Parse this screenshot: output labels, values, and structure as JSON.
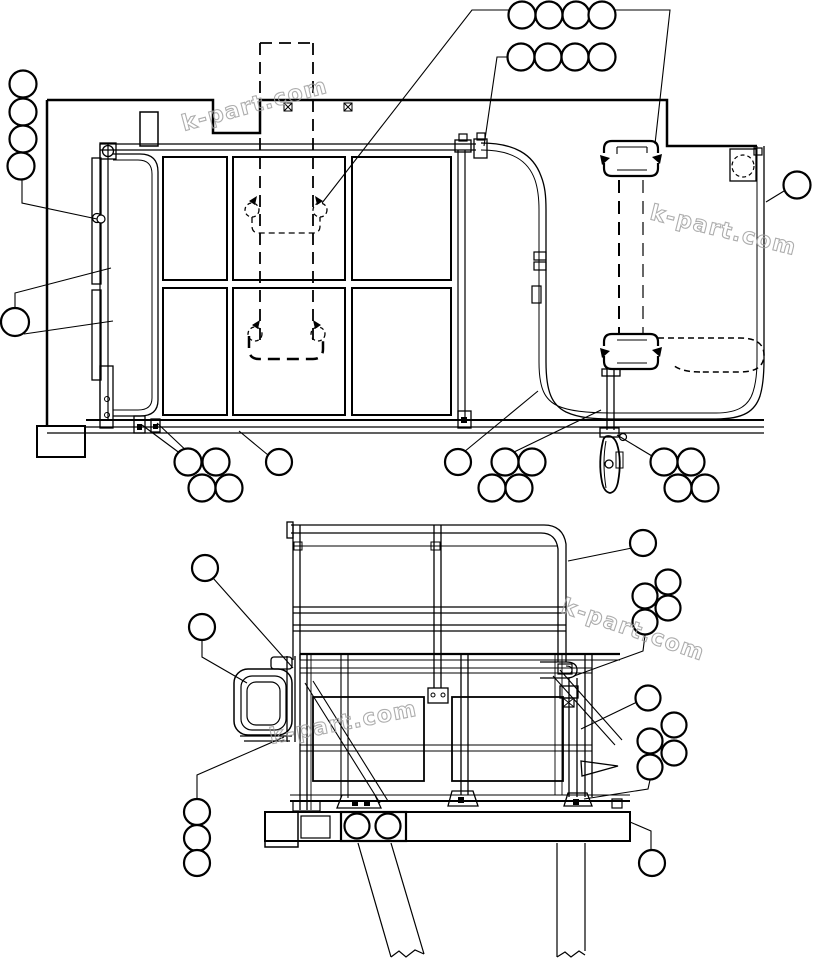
{
  "page": {
    "background": "#ffffff",
    "line_color": "#000000"
  },
  "watermark": {
    "text": "k-part.com",
    "color": "#9f9f9f",
    "font_size": 22,
    "instances": [
      {
        "x": 184,
        "y": 131,
        "rotation": -15
      },
      {
        "x": 649,
        "y": 219,
        "rotation": 14
      },
      {
        "x": 560,
        "y": 612,
        "rotation": 19
      },
      {
        "x": 271,
        "y": 744,
        "rotation": -11
      }
    ]
  },
  "top_view": {
    "title": "frame-and-guard-top-view",
    "callouts": [
      {
        "cx": 23,
        "cy": 84,
        "r": 13.5
      },
      {
        "cx": 23,
        "cy": 112,
        "r": 13.5
      },
      {
        "cx": 23,
        "cy": 139,
        "r": 13.5
      },
      {
        "cx": 21,
        "cy": 166,
        "r": 13.5
      },
      {
        "cx": 15,
        "cy": 322,
        "r": 14
      },
      {
        "cx": 522,
        "cy": 15,
        "r": 13.5
      },
      {
        "cx": 549,
        "cy": 15,
        "r": 13.5
      },
      {
        "cx": 576,
        "cy": 15,
        "r": 13.5
      },
      {
        "cx": 602,
        "cy": 15,
        "r": 13.5
      },
      {
        "cx": 521,
        "cy": 57,
        "r": 13.5
      },
      {
        "cx": 548,
        "cy": 57,
        "r": 13.5
      },
      {
        "cx": 575,
        "cy": 57,
        "r": 13.5
      },
      {
        "cx": 602,
        "cy": 57,
        "r": 13.5
      },
      {
        "cx": 797,
        "cy": 185,
        "r": 13.5
      },
      {
        "cx": 188,
        "cy": 462,
        "r": 13.5
      },
      {
        "cx": 216,
        "cy": 462,
        "r": 13.5
      },
      {
        "cx": 202,
        "cy": 488,
        "r": 13.5
      },
      {
        "cx": 229,
        "cy": 488,
        "r": 13.5
      },
      {
        "cx": 279,
        "cy": 462,
        "r": 13
      },
      {
        "cx": 458,
        "cy": 462,
        "r": 13
      },
      {
        "cx": 505,
        "cy": 462,
        "r": 13.5
      },
      {
        "cx": 532,
        "cy": 462,
        "r": 13.5
      },
      {
        "cx": 492,
        "cy": 488,
        "r": 13.5
      },
      {
        "cx": 519,
        "cy": 488,
        "r": 13.5
      },
      {
        "cx": 664,
        "cy": 462,
        "r": 13.5
      },
      {
        "cx": 691,
        "cy": 462,
        "r": 13.5
      },
      {
        "cx": 678,
        "cy": 488,
        "r": 13.5
      },
      {
        "cx": 705,
        "cy": 488,
        "r": 13.5
      }
    ],
    "callout_markers": [
      {
        "cx": 101,
        "cy": 219,
        "r": 4
      }
    ],
    "leader_lines": [
      {
        "points": [
          [
            22,
            178
          ],
          [
            22,
            203
          ],
          [
            97,
            219
          ]
        ]
      },
      {
        "points": [
          [
            15,
            308
          ],
          [
            15,
            293
          ],
          [
            111,
            268
          ]
        ]
      },
      {
        "points": [
          [
            24,
            334
          ],
          [
            113,
            321
          ]
        ]
      },
      {
        "points": [
          [
            322,
            203
          ],
          [
            472,
            10
          ],
          [
            670,
            10
          ],
          [
            655,
            144
          ]
        ]
      },
      {
        "points": [
          [
            509,
            57
          ],
          [
            497,
            57
          ],
          [
            484,
            146
          ]
        ]
      },
      {
        "points": [
          [
            784,
            191
          ],
          [
            766,
            202
          ]
        ]
      },
      {
        "points": [
          [
            142,
            425
          ],
          [
            185,
            457
          ]
        ]
      },
      {
        "points": [
          [
            157,
            423
          ],
          [
            191,
            455
          ]
        ]
      },
      {
        "points": [
          [
            268,
            455
          ],
          [
            239,
            431
          ]
        ]
      },
      {
        "points": [
          [
            464,
            452
          ],
          [
            538,
            391
          ]
        ]
      },
      {
        "points": [
          [
            512,
            453
          ],
          [
            601,
            410
          ]
        ]
      },
      {
        "points": [
          [
            652,
            456
          ],
          [
            617,
            435
          ]
        ]
      }
    ]
  },
  "side_view": {
    "title": "platform-side-view",
    "callouts": [
      {
        "cx": 205,
        "cy": 568,
        "r": 13
      },
      {
        "cx": 202,
        "cy": 627,
        "r": 13
      },
      {
        "cx": 643,
        "cy": 543,
        "r": 13
      },
      {
        "cx": 668,
        "cy": 582,
        "r": 12.5
      },
      {
        "cx": 645,
        "cy": 596,
        "r": 12.5
      },
      {
        "cx": 668,
        "cy": 608,
        "r": 12.5
      },
      {
        "cx": 645,
        "cy": 622,
        "r": 12.5
      },
      {
        "cx": 648,
        "cy": 698,
        "r": 12.5
      },
      {
        "cx": 674,
        "cy": 725,
        "r": 12.5
      },
      {
        "cx": 650,
        "cy": 741,
        "r": 12.5
      },
      {
        "cx": 674,
        "cy": 753,
        "r": 12.5
      },
      {
        "cx": 650,
        "cy": 767,
        "r": 12.5
      },
      {
        "cx": 197,
        "cy": 812,
        "r": 13
      },
      {
        "cx": 197,
        "cy": 838,
        "r": 13
      },
      {
        "cx": 197,
        "cy": 863,
        "r": 13
      },
      {
        "cx": 652,
        "cy": 863,
        "r": 13
      }
    ],
    "callout_markers": [],
    "leader_lines": [
      {
        "points": [
          [
            213,
            578
          ],
          [
            293,
            668
          ]
        ]
      },
      {
        "points": [
          [
            202,
            640
          ],
          [
            202,
            657
          ],
          [
            247,
            683
          ]
        ]
      },
      {
        "points": [
          [
            197,
            799
          ],
          [
            197,
            775
          ],
          [
            284,
            737
          ]
        ]
      },
      {
        "points": [
          [
            632,
            548
          ],
          [
            568,
            561
          ]
        ]
      },
      {
        "points": [
          [
            645,
            635
          ],
          [
            643,
            651
          ],
          [
            574,
            676
          ]
        ]
      },
      {
        "points": [
          [
            637,
            702
          ],
          [
            581,
            729
          ]
        ]
      },
      {
        "points": [
          [
            650,
            780
          ],
          [
            648,
            789
          ],
          [
            584,
            799
          ]
        ]
      },
      {
        "points": [
          [
            630,
            822
          ],
          [
            651,
            831
          ],
          [
            651,
            850
          ]
        ]
      }
    ]
  }
}
